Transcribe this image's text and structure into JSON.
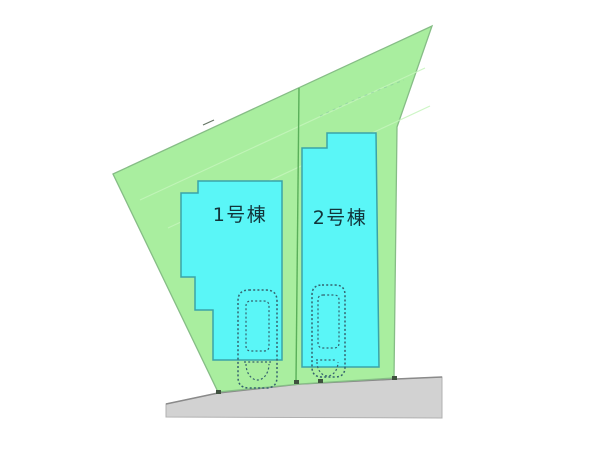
{
  "page": {
    "background": "#ffffff"
  },
  "site_plan": {
    "lots": [
      {
        "building_label": "1号棟"
      },
      {
        "building_label": "2号棟"
      }
    ],
    "colors": {
      "land_green": "#a9ee9f",
      "land_border": "#86bd86",
      "building_cyan": "#5af6f7",
      "building_border": "#3aa3a8",
      "road_gray": "#d2d2d2",
      "road_border": "#b0b0b0",
      "road_edge_line": "#8a8a8a",
      "divider_green": "#5aaf5a",
      "car_outline": "#35626e",
      "label_text": "#12343a",
      "marker_dark": "#3f523f",
      "contour_faint": "#c4f4bb",
      "survey_faint": "#79b79f"
    },
    "geometry": {
      "parcel": "113,174 432,26 397,127 394,378 300,384 218,392",
      "road": "166,404 218,393 300,384 396,379 442,377 442,418 166,417",
      "road_top_edge": "M166,404 L218,393 L300,384 L396,379 L442,377",
      "divider": "M299,88 L296,382",
      "building1": "198,181 282,181 282,360 213,360 213,310 195,310 195,277 181,277 181,193 198,193",
      "building2": "327,133 376,133 379,367 302,367 302,148 327,148",
      "contours": "M140,200 L425,68 M168,228 L430,106",
      "survey_dashes": "M320,116 L356,99 L404,80",
      "dim_tick": "M203,125 L214,120",
      "markers": "M216,390 h5 v4 h-5 z M294,380 h5 v4 h-5 z M318,379 h5 v4 h-5 z M392,376 h5 v4 h-5 z",
      "car1_outer": "M249,290 h17 q11,0 11,11 v76 q0,11 -11,11 h-17 q-11,0 -11,-11 v-76 q0,-11 11,-11 z",
      "car1_inner": "M251,301 h13 q5,0 5,5 v40 q0,5 -5,5 h-13 q-5,0 -5,-5 v-40 q0,-5 5,-5 z",
      "car1_rear_line": "M244,362 L271,362",
      "car1_rear_arc": "M246,364 a11.5,16 0 0 0 23,0",
      "car2_outer": "M322,285 h13 q10,0 10,10 v72 q0,10 -10,10 h-13 q-10,0 -10,-10 v-72 q0,-10 10,-10 z",
      "car2_inner": "M323,295 h11 q5,0 5,5 v43 q0,5 -5,5 h-11 q-5,0 -5,-5 v-43 q0,-5 5,-5 z",
      "car2_rear_line": "M316,360 L337,360",
      "car2_rear_arc": "M317,362 a10.5,14 0 0 0 21,0",
      "label1_x": "240",
      "label1_y": "221",
      "label2_x": "340",
      "label2_y": "224"
    }
  }
}
